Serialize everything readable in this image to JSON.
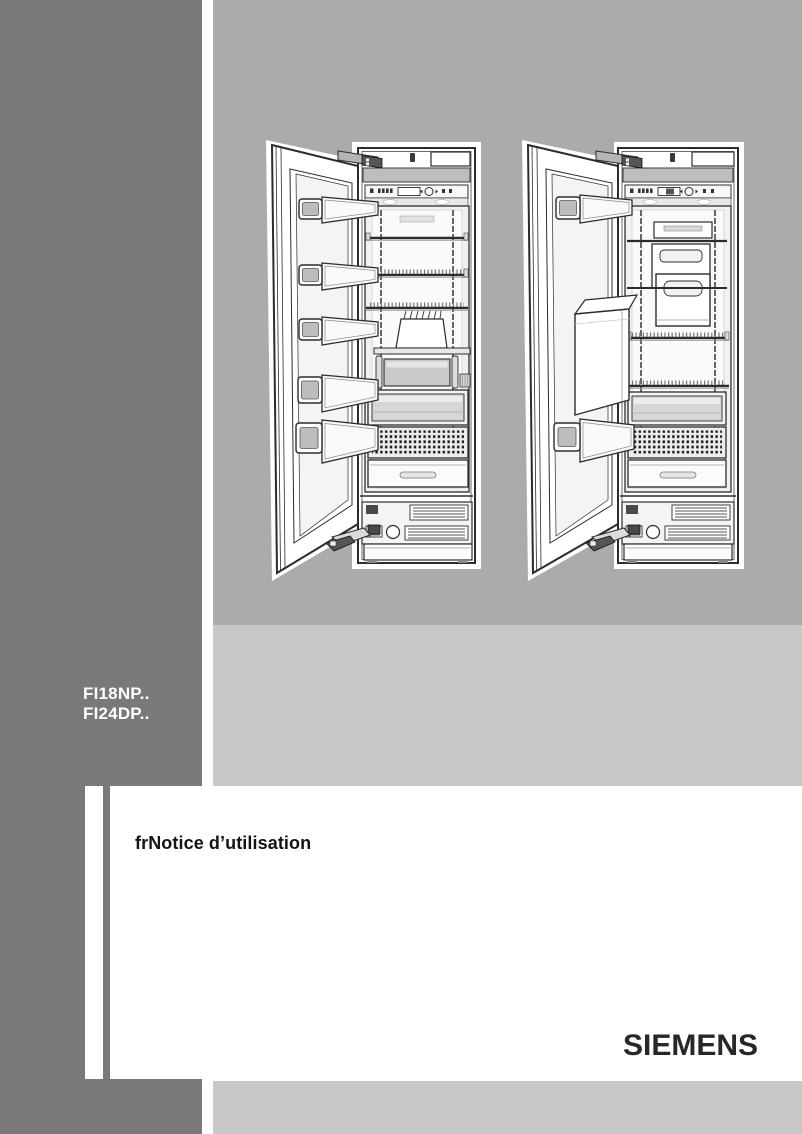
{
  "sidebar": {
    "models": [
      "FI18NP..",
      "FI24DP.."
    ]
  },
  "main": {
    "title": "frNotice d’utilisation"
  },
  "footer": {
    "brand": "SIEMENS"
  },
  "illustrations": {
    "left": "upright-freezer-open-door-five-door-bins",
    "right": "upright-freezer-open-door-ice-dispenser"
  },
  "colors": {
    "sidebar_gray": "#7a787a",
    "illustration_panel_gray": "#ababab",
    "band_gray": "#c8c8c8",
    "models_text": "#ffffff",
    "title_text": "#141414",
    "brand_text": "#2a2528"
  }
}
